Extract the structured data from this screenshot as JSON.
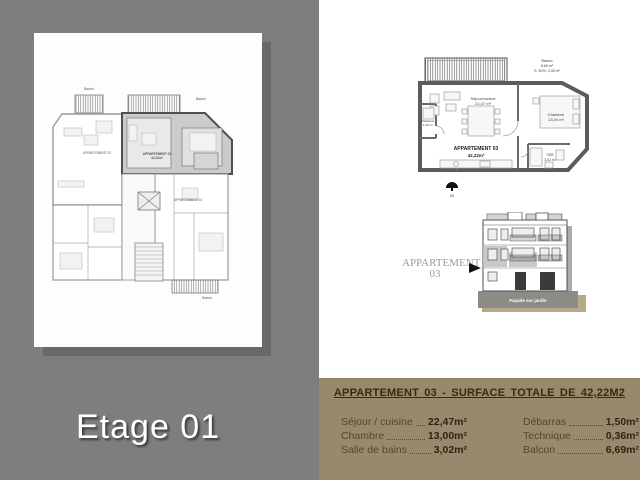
{
  "slide": {
    "floor_title": "Etage 01"
  },
  "main_plan": {
    "apartment02_label": "APPARTEMENT 02",
    "apartment03_label": "APPARTEMENT 03",
    "apartment03_area": "42,22m²",
    "apartment04_label": "APPARTEMENT 04",
    "balcony_top_left": "Balcon",
    "balcony_top_right": "Balcon",
    "balcony_bottom": "Balcon"
  },
  "detail_plan": {
    "balcony_name": "Balcon",
    "balcony_area": "6,69 m²",
    "balcony_note": "S. 50%: 3,35 m²",
    "sejour_label": "Séjour/cuisine",
    "sejour_area": "22,47 m²",
    "chambre_label": "Chambre",
    "chambre_area": "13,00 m²",
    "debarras_label": "Débarras",
    "debarras_area": "1,50 m²",
    "sdb_label": "SDB",
    "sdb_area": "3,02 m²",
    "apartment_label": "APPARTEMENT 03",
    "apartment_area": "42,22m²",
    "marker_label": "03"
  },
  "elevation": {
    "callout_line1": "APPARTEMENT",
    "callout_line2": "03",
    "base_label": "Façade sur jardin"
  },
  "surface_table": {
    "title": "APPARTEMENT 03  -  SURFACE TOTALE DE 42,22M2",
    "columns": [
      {
        "rows": [
          {
            "label": "Séjour / cuisine",
            "value": "22,47m²"
          },
          {
            "label": "Chambre",
            "value": "13,00m²"
          },
          {
            "label": "Salle de bains",
            "value": "3,02m²"
          }
        ]
      },
      {
        "rows": [
          {
            "label": "Débarras",
            "value": "1,50m²"
          },
          {
            "label": "Technique",
            "value": "0,36m²"
          },
          {
            "label": "Balcon",
            "value": "6,69m²"
          }
        ]
      }
    ]
  },
  "colors": {
    "background": "#7e7e7e",
    "paper": "#fdfdfd",
    "panel": "#96896e",
    "panel_title_text": "#372a10",
    "highlight": "#c9c9c9"
  }
}
